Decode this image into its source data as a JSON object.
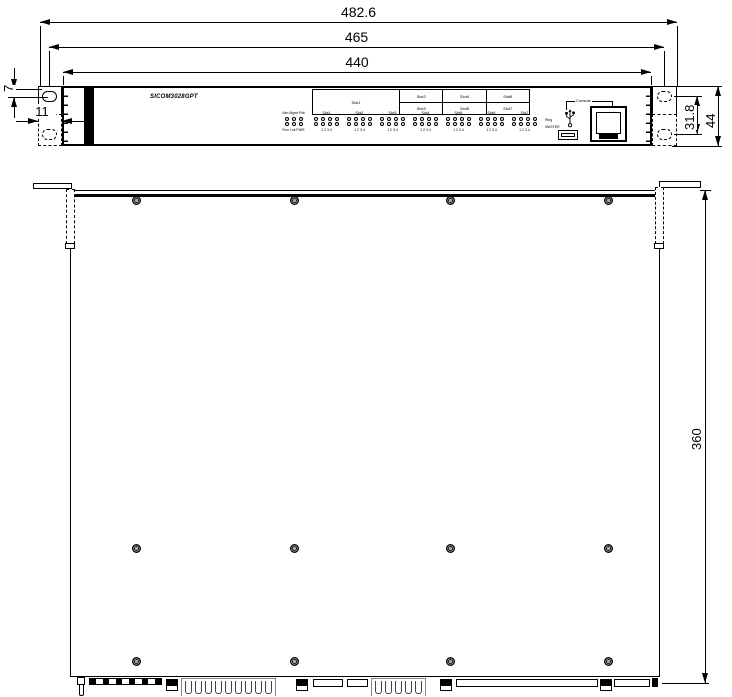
{
  "title": "SICOM3028GPT dimensional drawing",
  "dimensions": {
    "overall_width": "482.6",
    "mounting_hole_width": "465",
    "chassis_width": "440",
    "ear_hole_top_offset": "7",
    "ear_depth": "11",
    "mounting_hole_spacing": "31.8",
    "overall_height": "44",
    "chassis_depth": "360"
  },
  "front_view": {
    "model_label": "SICOM3028GPT",
    "slot_table": {
      "main_cell": "Slot1",
      "top_row": [
        "Slot2",
        "Slot4",
        "Slot6"
      ],
      "bottom_row": [
        "Slot3",
        "Slot5",
        "Slot7"
      ]
    },
    "leds": {
      "status_top_label": "Alm Mgmt Rdt",
      "status_bottom_label": "Run Lnk PWR",
      "slot_groups": [
        "Slot1",
        "Slot2",
        "Slot3",
        "Slot4",
        "Slot5",
        "Slot6",
        "Slot7"
      ],
      "port_numbers": "1 2 3 4",
      "ring_label": "Ring",
      "master_label": "MASTER"
    },
    "console_label": "Console"
  }
}
